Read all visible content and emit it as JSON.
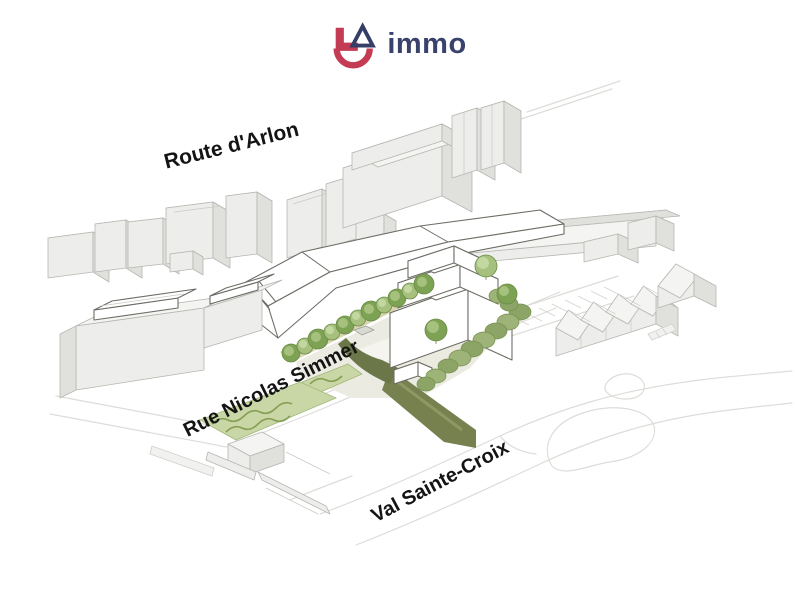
{
  "logo": {
    "wordmark": "immo",
    "colors": {
      "mark_red": "#c43b54",
      "mark_navy": "#353e66",
      "wordmark_navy": "#39426b"
    }
  },
  "map": {
    "type": "axonometric-site-plan",
    "street_labels": [
      {
        "id": "route-arlon",
        "text": "Route d'Arlon",
        "rotation_deg": -14
      },
      {
        "id": "rue-nicolas-simmer",
        "text": "Rue Nicolas Simmer",
        "rotation_deg": -26.5
      },
      {
        "id": "val-sainte-croix",
        "text": "Val Sainte-Croix",
        "rotation_deg": -28
      }
    ],
    "colors": {
      "existing_building_front": "#ededeb",
      "existing_building_side": "#e0e0dd",
      "existing_building_top": "#f4f4f2",
      "existing_outline": "#b6b6b1",
      "project_building": "#ffffff",
      "project_outline": "#6d6d66",
      "tree_green_dark": "#7ea254",
      "tree_green_light": "#a6c17e",
      "hedge_green": "#8ca567",
      "garden_green": "#c9d6a5",
      "path_olive_dark": "#6b7749",
      "path_olive": "#76814f",
      "plaza": "#ecebe2",
      "tan_path": "#dbd4b4",
      "road_line": "#dcdcd8",
      "label_text": "#141414"
    }
  }
}
